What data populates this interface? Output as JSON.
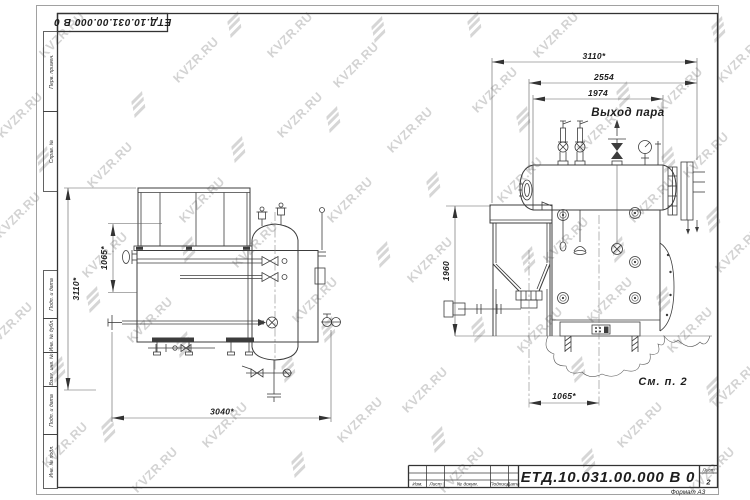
{
  "stamp_top": {
    "doc_number": "ЕТД.10.031.00.000  В 0"
  },
  "margin_labels": {
    "perv": "Перв. примен.",
    "sprav": "Справ. №",
    "podp1": "Подп. и дата",
    "inv_dubl": "Инв. № дубл.",
    "vzam": "Взам. инв. №",
    "podp2": "Подп. и дата",
    "inv_podl": "Инв. № подл."
  },
  "title_block": {
    "doc_number": "ЕТД.10.031.00.000  В 0",
    "columns": [
      "Изм.",
      "Лист",
      "№ докум.",
      "Подпись",
      "Дата"
    ],
    "sheet_label": "Лист",
    "sheet_number": "2",
    "format_label": "Формат А3"
  },
  "watermark": {
    "text": "KVZR.RU",
    "color": "#d3d3d3"
  },
  "views": {
    "left": {
      "dim_height": "3110*",
      "dim_upper": "1065*",
      "dim_width": "3040*"
    },
    "right": {
      "dim_overall_width": "3110*",
      "dim_drum_total": "2554",
      "dim_drum_shell": "1974",
      "dim_height": "1960",
      "dim_axis_spacing": "1065*",
      "steam_outlet": "Выход пара",
      "note": "См. п. 2"
    }
  }
}
